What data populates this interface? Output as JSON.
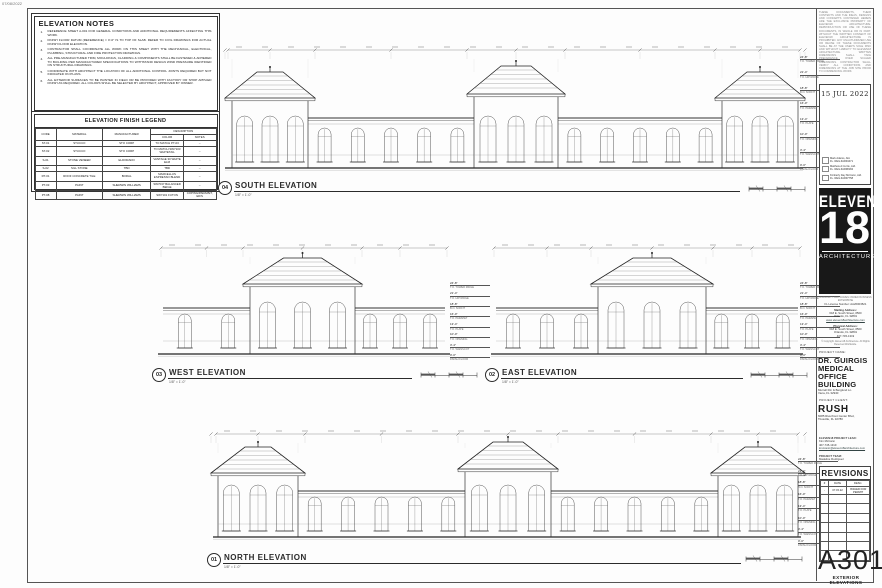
{
  "print_date": "07/08/2022",
  "notes_panel": {
    "title": "ELEVATION NOTES",
    "notes": [
      "REFERENCE SHEET A-001 FOR GENERAL CONDITIONS AND ADDITIONAL REQUIREMENTS AFFECTING THIS WORK.",
      "FINISH FLOOR DATUM (REFERENCE) = 0'-0\" IS TO TOP OF SLAB.  REFER TO CIVIL DRAWINGS FOR ACTUAL FINISH FLOOR ELEVATION.",
      "CONTRACTOR SHALL COORDINATE ALL WORK ON THIS SHEET WITH THE MECHANICAL, ELECTRICAL, PLUMBING, STRUCTURAL AND FIRE PROTECTION DRAWINGS.",
      "ALL PRE-MANUFACTURED TRIM, MOULDINGS, CLADDING & COMPONENTS SHALL BE FASTENED & ADHERED TO BUILDING PER MANUFACTURER SPECIFICATIONS TO WITHSTAND DESIGN WIND PRESSURE IDENTIFIED ON STRUCTURAL DRAWINGS.",
      "COORDINATE WITH ARCHITECT THE LOCATION OF ALL ADDITIONAL CONTROL JOINTS REQUIRED BUT NOT INDICATED ON PLANS.",
      "ALL EXTERIOR SURFACES TO BE PAINTED IN FIELD OR BE PROVIDED WITH FACTORY OR SHOP APPLIED FINISH AS REQUIRED.  ALL COLORS SHALL BE SELECTED BY ARCHITECT, APPROVED BY OWNER."
    ]
  },
  "legend": {
    "title": "ELEVATION FINISH LEGEND",
    "headers": {
      "code": "CODE",
      "material": "MATERIAL",
      "manufacturer": "MANUFACTURER",
      "description": "DESCRIPTION",
      "color": "COLOR",
      "notes": "NOTES"
    },
    "rows": [
      [
        "ST-01",
        "STUCCO",
        "STO CORP",
        "TO MATCH PT-03",
        "--"
      ],
      [
        "ST-02",
        "STUCCO",
        "STO CORP",
        "TO MATCH SW7103 WHITETAIL",
        "--"
      ],
      [
        "S-01",
        "STONE VENEER",
        "ELDORADO",
        "VANTAGE 30 WHITE ELM",
        "--"
      ],
      [
        "S-02",
        "SILL STONE",
        "TBD",
        "TBD",
        "--"
      ],
      [
        "RT-01",
        "ROOF CONCRETE TILE",
        "BORAL",
        "MARCELLUS ESPRESSO BLEND",
        "--"
      ],
      [
        "PT-03",
        "PAINT",
        "SHERWIN WILLIAMS",
        "SW7037 BALANCED BEIGE",
        "--"
      ],
      [
        "PT-08",
        "PAINT",
        "SHERWIN WILLIAMS",
        "SW7101 FUTON",
        "COPING/PARAPET, EIFS"
      ]
    ]
  },
  "elevations": {
    "south": {
      "number": "04",
      "title": "SOUTH ELEVATION",
      "scale": "1/8\" = 1'-0\""
    },
    "west": {
      "number": "03",
      "title": "WEST ELEVATION",
      "scale": "1/8\" = 1'-0\""
    },
    "east": {
      "number": "02",
      "title": "EAST ELEVATION",
      "scale": "1/8\" = 1'-0\""
    },
    "north": {
      "number": "01",
      "title": "NORTH ELEVATION",
      "scale": "1/8\" = 1'-0\""
    },
    "levels": [
      {
        "elev": "24'-8\"",
        "label": "T.O. TOWER RIDGE"
      },
      {
        "elev": "21'-4\"",
        "label": "T.O. HIP RIDGE"
      },
      {
        "elev": "18'-8\"",
        "label": "B.O. SOFFIT"
      },
      {
        "elev": "16'-0\"",
        "label": "T.O. PARAPET"
      },
      {
        "elev": "13'-4\"",
        "label": "T.O. PLATE"
      },
      {
        "elev": "10'-0\"",
        "label": "T.O. OPENING"
      },
      {
        "elev": "3'-4\"",
        "label": "T.O. WAINSCOT"
      },
      {
        "elev": "0'-0\"",
        "label": "FINISH FLOOR"
      }
    ]
  },
  "titleblock": {
    "copyright": "THESE DOCUMENTS, THEIR CONTENTS AND THE IDEAS, DESIGNS AND CONCEPTS CONTAINED HEREIN ARE THE EXCLUSIVE PROPERTY OF ELEVEN18 ARCHITECTURE. REPRODUCTION OR USE OF THESE DOCUMENTS, IN WHOLE OR IN PART, WITHOUT THE WRITTEN CONSENT OF ELEVEN18 ARCHITECTURE IS PROHIBITED. ANY UNAUTHORIZED USE OR REUSE OF THESE DOCUMENTS SHALL BE AT THE USER'S SOLE RISK AND WITHOUT LIABILITY TO ELEVEN18 ARCHITECTURE. WRITTEN DIMENSIONS SHALL TAKE PRECEDENCE OVER SCALED DIMENSIONS. CONTRACTOR SHALL VERIFY ALL CONDITIONS AND DIMENSIONS AT THE JOB SITE PRIOR TO COMMENCING WORK.",
    "stamp_date": "15 JUL 2022",
    "architects": [
      {
        "name": "Mark Adams, AIA",
        "reg": "FL. REG.#AR94471"
      },
      {
        "name": "Matthew A Currie, AIA",
        "reg": "FL. REG.#AR98184"
      },
      {
        "name": "Kimberly Day McCann, AIA",
        "reg": "FL. REG.#AR97758"
      }
    ],
    "logo": {
      "line1": "ELEVEN",
      "line2": "18",
      "line3": "ARCHITECTURE"
    },
    "firm": {
      "tagline": "A MINORITY AND WOMEN OWNED BUSINESS ENTERPRISE",
      "license": "FL License Number: AA26003521",
      "mailing_label": "Mailing Address:",
      "mailing1": "618 E. South Street, #500",
      "mailing2": "Orlando, FL 32801",
      "website": "www.eleven18architecture.com",
      "physical_label": "Physical Address:",
      "physical1": "618 E. South Street, #500",
      "physical2": "Orlando, FL 32801",
      "phone": "407-745-1319",
      "copyright": "© Copyright. Eleven18 Architecture. All Rights Reserved Worldwide."
    },
    "project_name_label": "PROJECT NAME:",
    "project_name": "DR. GUIRGIS MEDICAL OFFICE BUILDING",
    "project_address1": "Murrell Rd. & Berglund Ln.",
    "project_address2": "Viera, FL 32940",
    "client_label": "PROJECT CLIENT:",
    "client_name": "RUSH",
    "client_address1": "6085 Riverfront Center Blvd,",
    "client_address2": "Titusville, FL 32780",
    "lead_label": "ELEVEN18 PROJECT LEAD:",
    "lead_name": "Kim McCann",
    "lead_phone": "407-745-1319",
    "lead_email": "kmccann@eleven18architecture.com",
    "team_label": "PROJECT TEAM:",
    "team_name": "Madeline Rodriguez",
    "revisions": {
      "title": "REVISIONS",
      "headers": [
        "#",
        "DATE",
        "DESC."
      ],
      "rows": [
        [
          "-",
          "07.15.22",
          "ISSUED FOR PERMIT"
        ]
      ],
      "empty_rows": 7
    },
    "sheet_number": "A301",
    "sheet_title": "EXTERIOR ELEVATIONS"
  }
}
